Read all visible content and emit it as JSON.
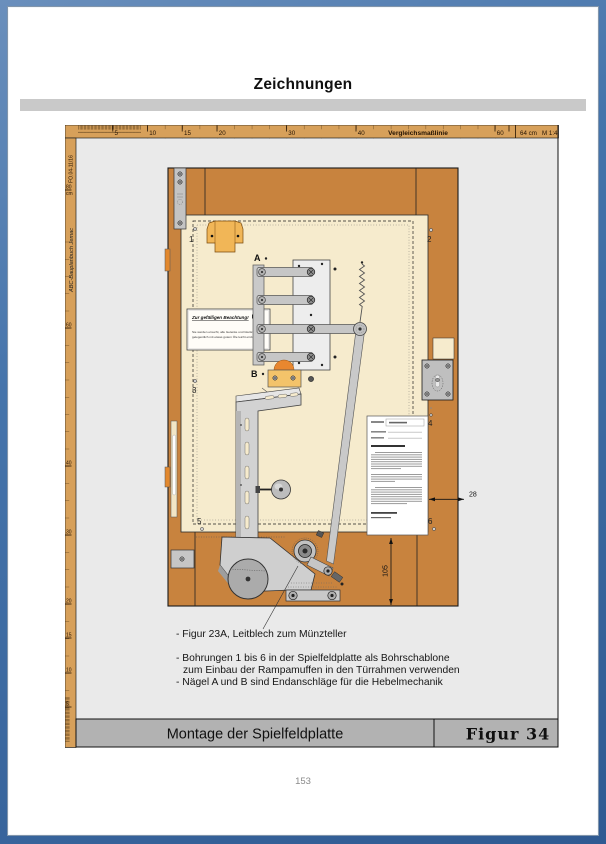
{
  "header": {
    "title": "Zeichnungen"
  },
  "page": {
    "number": "153"
  },
  "sheet": {
    "top_ruler": {
      "ticks": [
        "5",
        "10",
        "15",
        "20",
        "30",
        "40",
        "60"
      ],
      "comparison_label": "Vergleichsmaßlinie",
      "length_label": "64 cm",
      "scale_label": "M 1:4"
    },
    "left_ruler": {
      "doc_code": "FO.04-11/16",
      "unit": "cm",
      "ticks": [
        "80",
        "60",
        "40",
        "30",
        "20",
        "15",
        "10",
        "5"
      ],
      "brand": "ABC-Bauplanbuch Jemac"
    },
    "drawing": {
      "holes": [
        "1",
        "2",
        "3",
        "4",
        "5",
        "6"
      ],
      "nails": [
        "A",
        "B"
      ],
      "dim_frame_width": "28",
      "dim_bottom_height": "105",
      "notice": {
        "title": "Zur gefälligen Beachtung!",
        "line1": "Sie werden ersucht, alle Gelenke und Gleitstellen",
        "line2": "gelegentlich mit etwas gutem Öle leicht einzuölen."
      }
    },
    "annotations": {
      "line1": "- Figur 23A, Leitblech zum Münzteller",
      "line2": "- Bohrungen 1 bis 6 in der Spielfeldplatte als Bohrschablone",
      "line3": "zum Einbau der Rampamuffen in den Türrahmen verwenden",
      "line4": "- Nägel A und B sind Endanschläge für die Hebelmechanik"
    },
    "footer": {
      "title": "Montage der Spielfeldplatte",
      "figure": "Figur  34"
    }
  },
  "colors": {
    "frame_blue": "#3e6da6",
    "ruler_tan": "#d7a05a",
    "door_orange": "#c8833e",
    "panel_cream": "#f6ebcd"
  }
}
